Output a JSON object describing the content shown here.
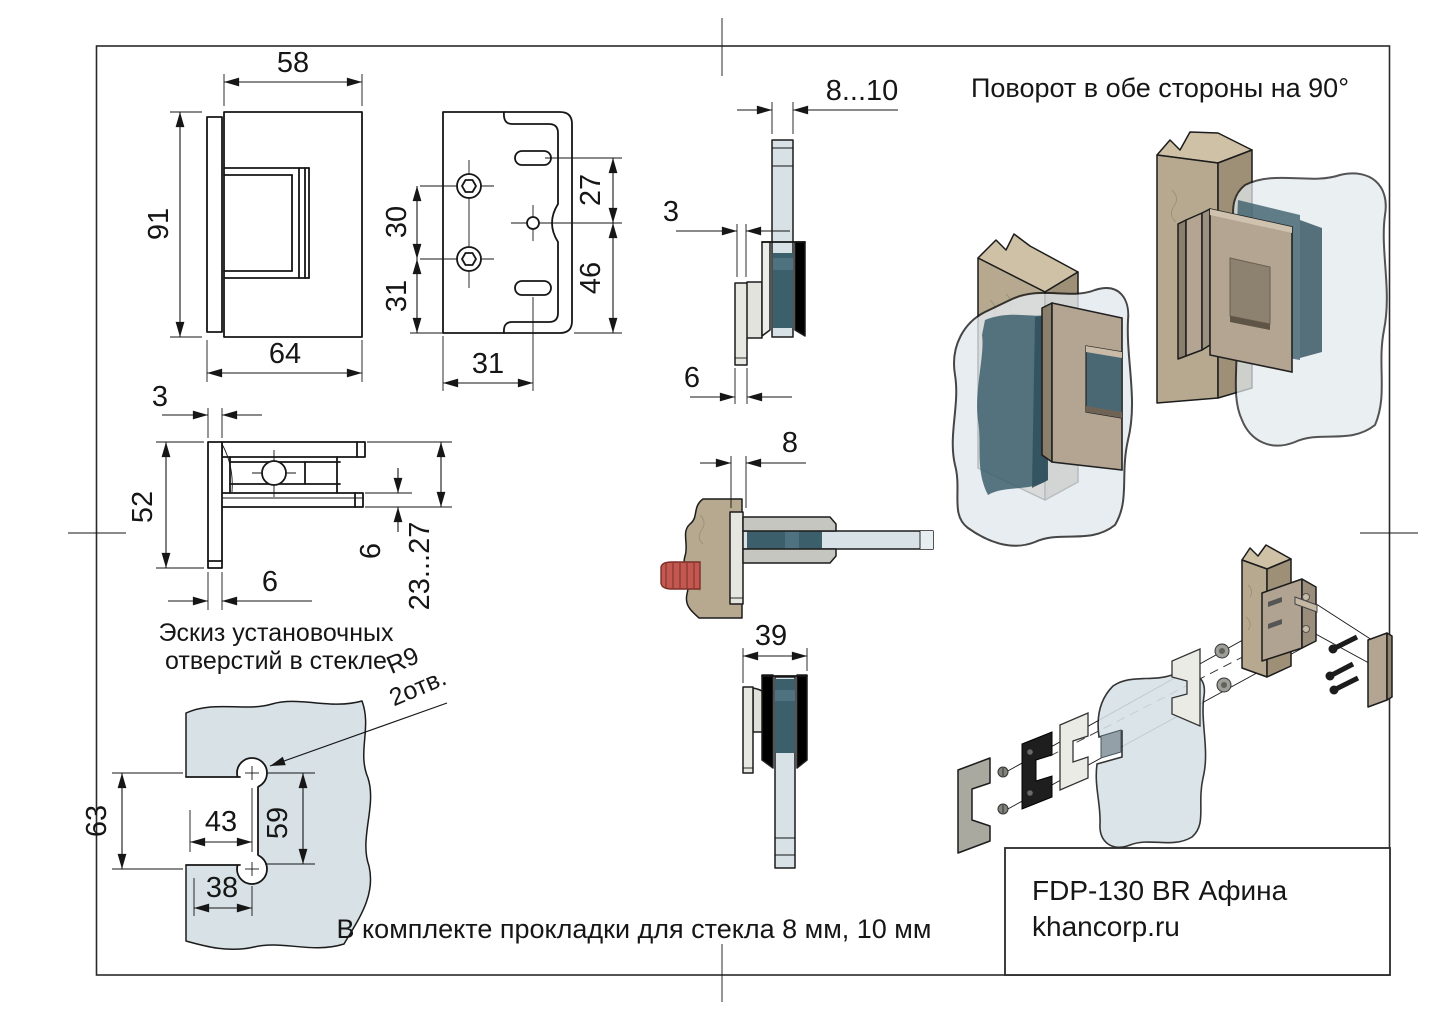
{
  "drawing": {
    "rotation_note": "Поворот в обе стороны на 90°",
    "kit_note": "В комплекте прокладки для стекла 8 мм, 10 мм",
    "sketch_caption_line1": "Эскиз установочных",
    "sketch_caption_line2": "отверстий в стекле",
    "hole_radius_label": "R9",
    "hole_count_label": "2отв."
  },
  "title_block": {
    "model": "FDP-130 BR Афина",
    "website": "khancorp.ru"
  },
  "dimensions": {
    "front": {
      "top_width": "58",
      "height": "91",
      "bottom_width": "64"
    },
    "plate": {
      "hole_spacing": "30",
      "hole_to_bottom": "31",
      "slot_to_center": "27",
      "center_to_bottom": "46",
      "bottom_offset": "31"
    },
    "side": {
      "glass_thickness": "8...10",
      "plate_gap": "3",
      "plate_thickness": "6"
    },
    "top": {
      "gap": "3",
      "depth": "52",
      "plate_thickness": "6",
      "jaw_thickness": "6",
      "clamp_range": "23...27"
    },
    "section": {
      "inset": "8"
    },
    "width_view": {
      "total": "39"
    },
    "glass_holes": {
      "edge_height": "63",
      "hole_offset_x": "43",
      "hole_spacing_y": "59",
      "lower_offset_x": "38"
    }
  },
  "colors": {
    "glass": "#d7e1e6",
    "glass_light": "#e7eef2",
    "gasket_teal": "#3c5f6c",
    "gasket_teal_light": "#4e7280",
    "wall_tan": "#b6a98f",
    "wall_tan_light": "#cfc1a6",
    "wall_tan_dark": "#9d9077",
    "hinge_bronze": "#b4a593",
    "hinge_bronze_dark": "#8a7e6c",
    "screw_red": "#c2584f",
    "metal_gray": "#e8e8e2",
    "black_rubber": "#1e1e1e"
  }
}
